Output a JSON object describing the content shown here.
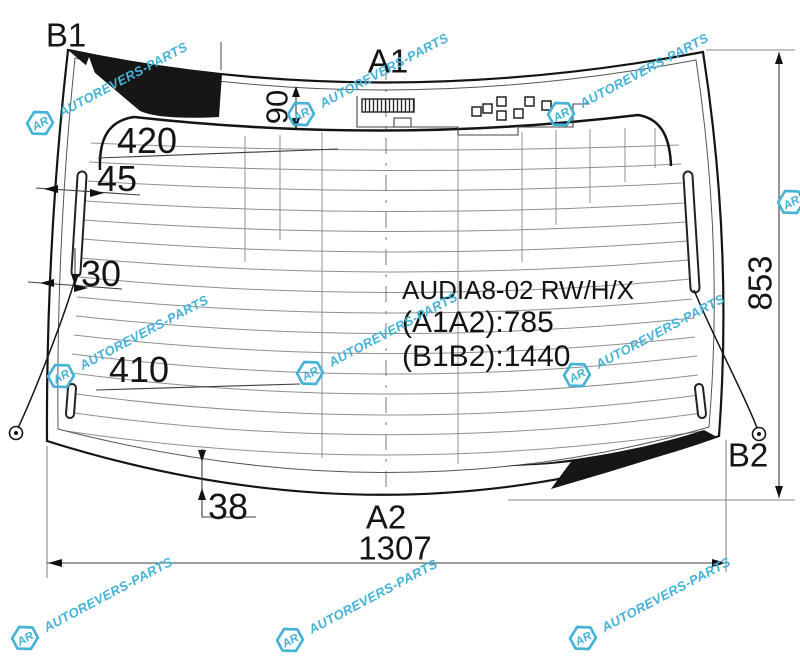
{
  "title_block": {
    "part_code": "AUDIA8-02 RW/H/X",
    "dim_a1a2": "(A1A2):785",
    "dim_b1b2": "(B1B2):1440"
  },
  "points": {
    "b1": "B1",
    "a1": "A1",
    "a2": "A2",
    "b2": "B2"
  },
  "dimensions": {
    "band_height": "90",
    "upper_left": "420",
    "edge_to_heater": "45",
    "lower_edge_offset": "30",
    "lower_left": "410",
    "bottom_gap": "38",
    "right_height": "853",
    "bottom_width": "1307"
  },
  "watermark": {
    "text": "AUTOREVERS-PARTS",
    "logo": "AR",
    "color": "#45b2d7"
  }
}
